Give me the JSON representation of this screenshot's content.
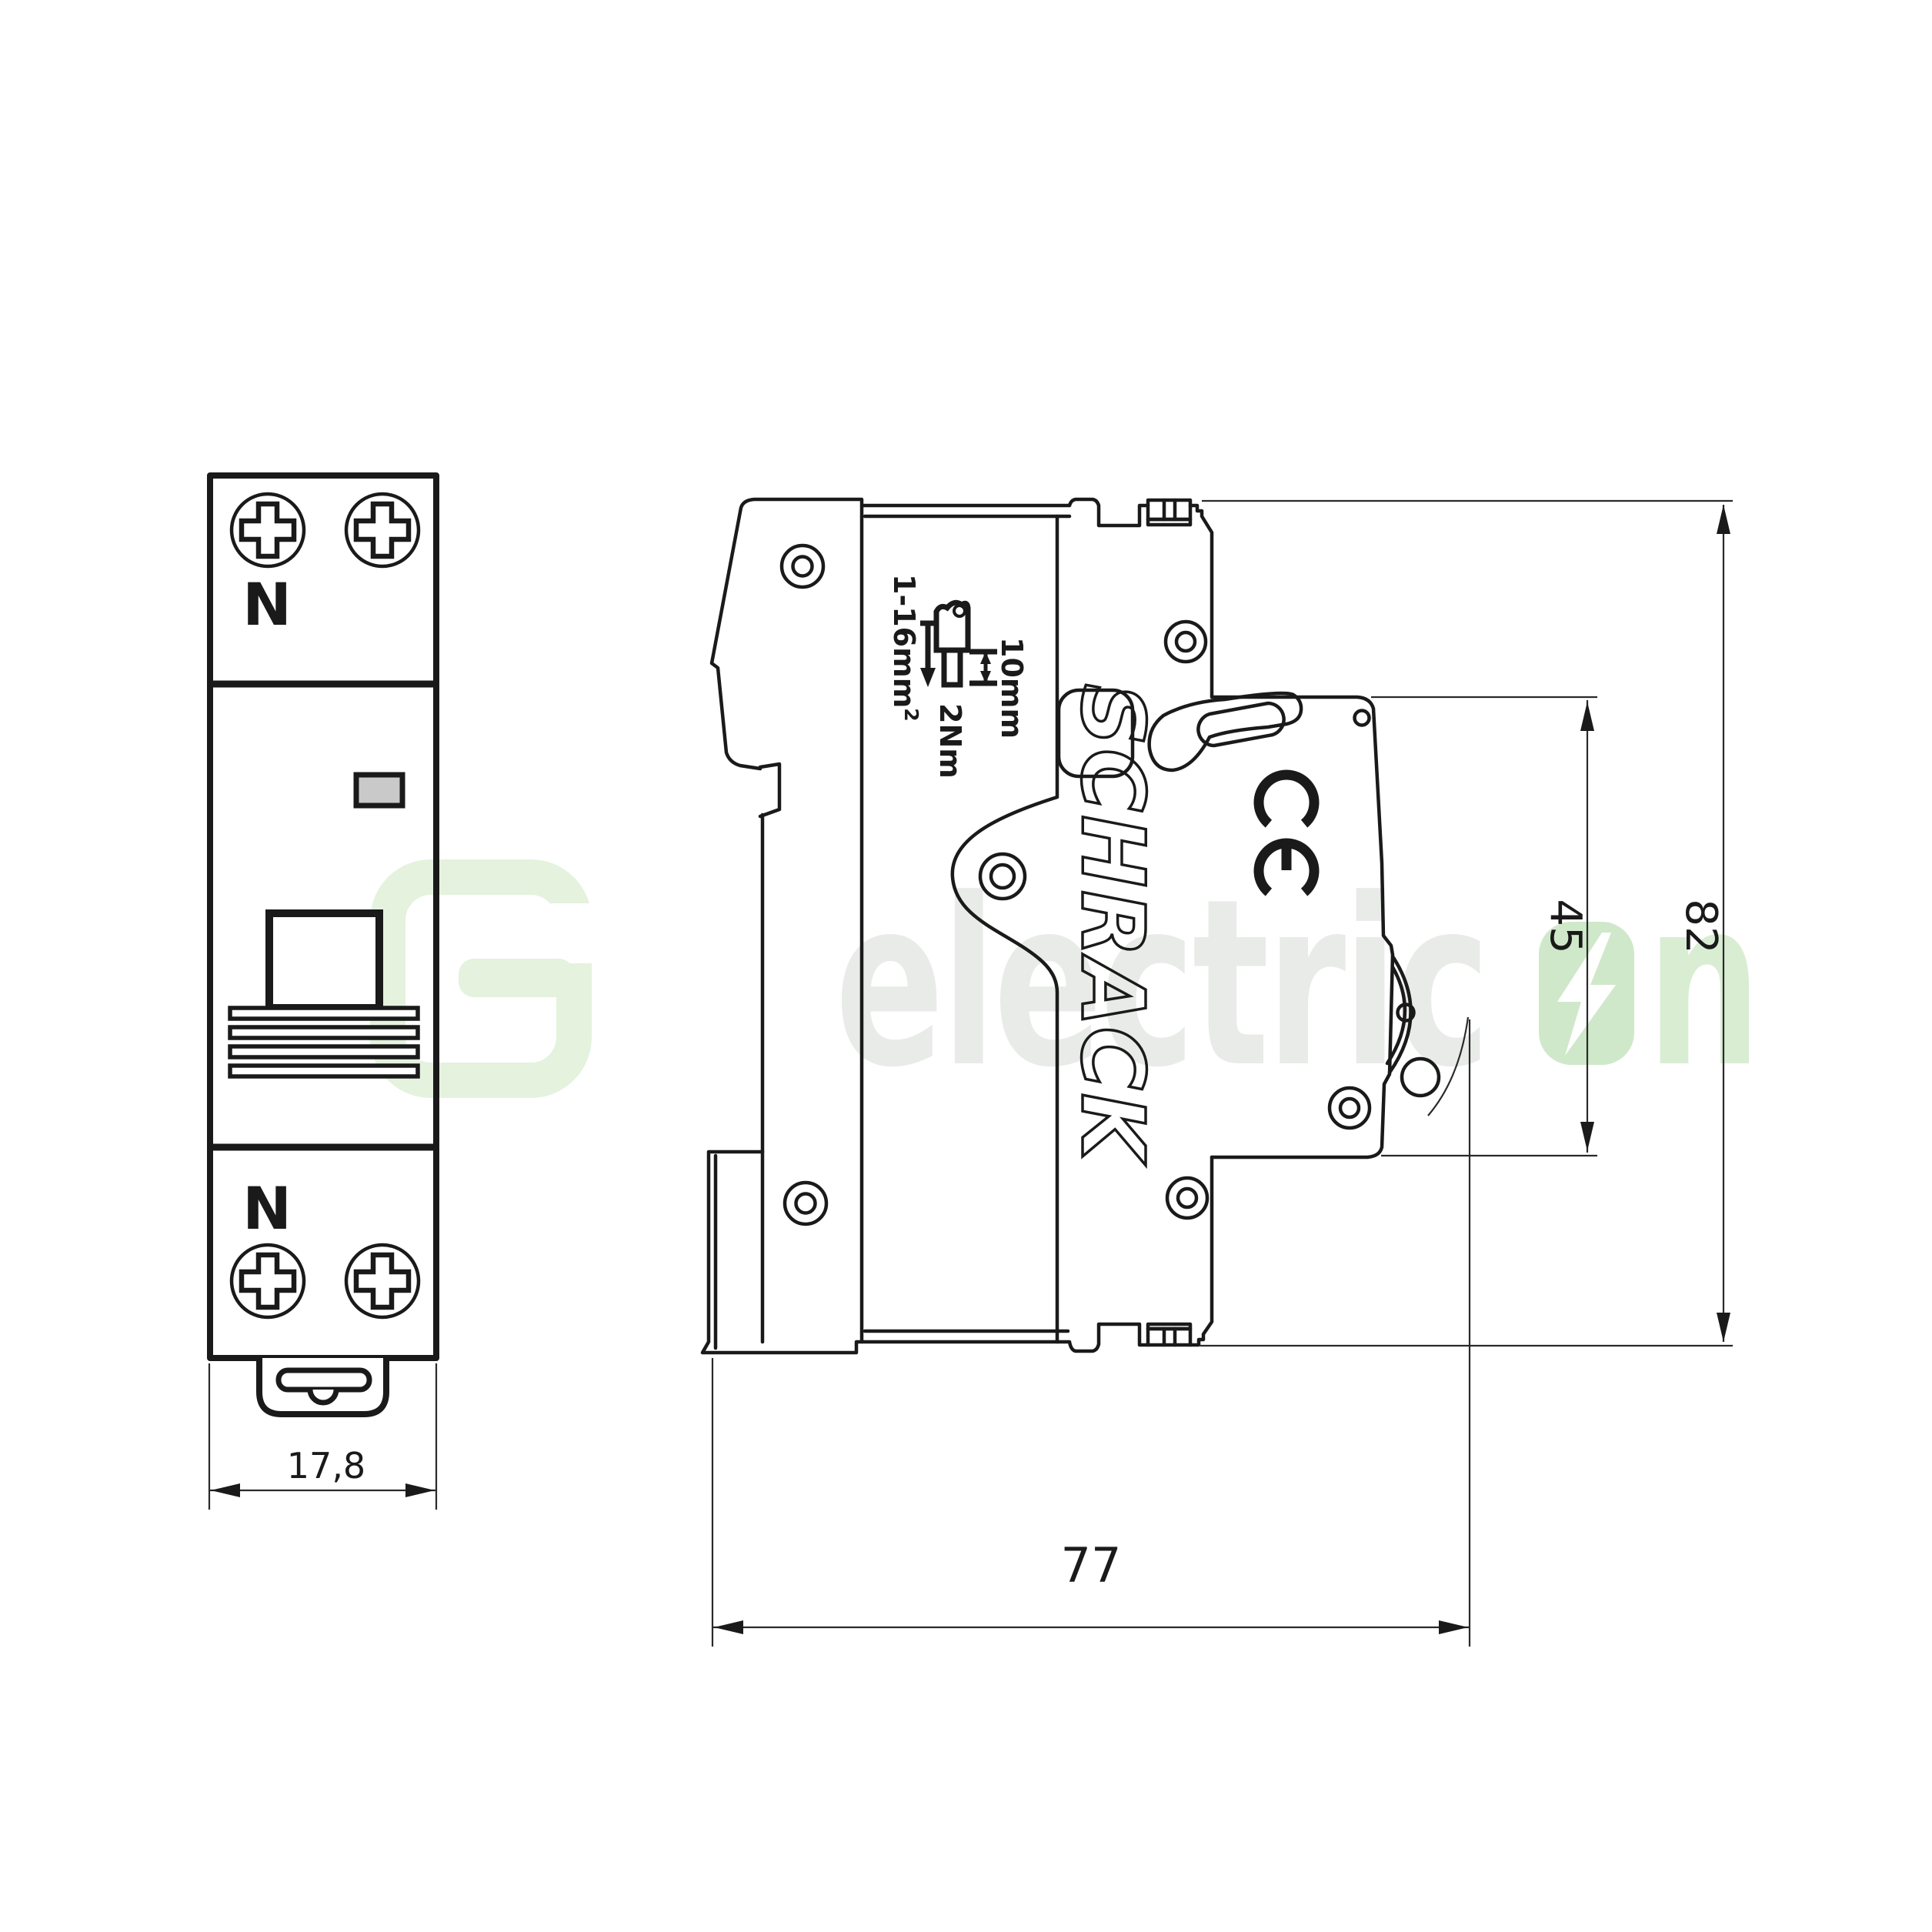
{
  "front_view": {
    "top_terminal_label": "N",
    "bottom_terminal_label": "N",
    "width_dim": "17,8"
  },
  "side_view": {
    "brand": "SCHRACK",
    "ce_mark": "CE",
    "wire_range": "1-16mm",
    "wire_range_exp": "2",
    "strip_length": "10mm",
    "torque": "2Nm",
    "front_height_dim": "45",
    "total_height_dim": "82",
    "depth_dim": "77"
  },
  "watermark": {
    "text_gray": "electric",
    "text_green_n": "n",
    "colors": {
      "letters_gray": "#e9ebe8",
      "letters_green": "#d9edd3",
      "bolt_tile_green": "#cfe8ca",
      "logo_green": "#e4f2de"
    }
  },
  "colors": {
    "line": "#1a1a1a",
    "dimension": "#2a2a2a",
    "indicator_fill": "#c9c9c9",
    "background": "#ffffff"
  }
}
